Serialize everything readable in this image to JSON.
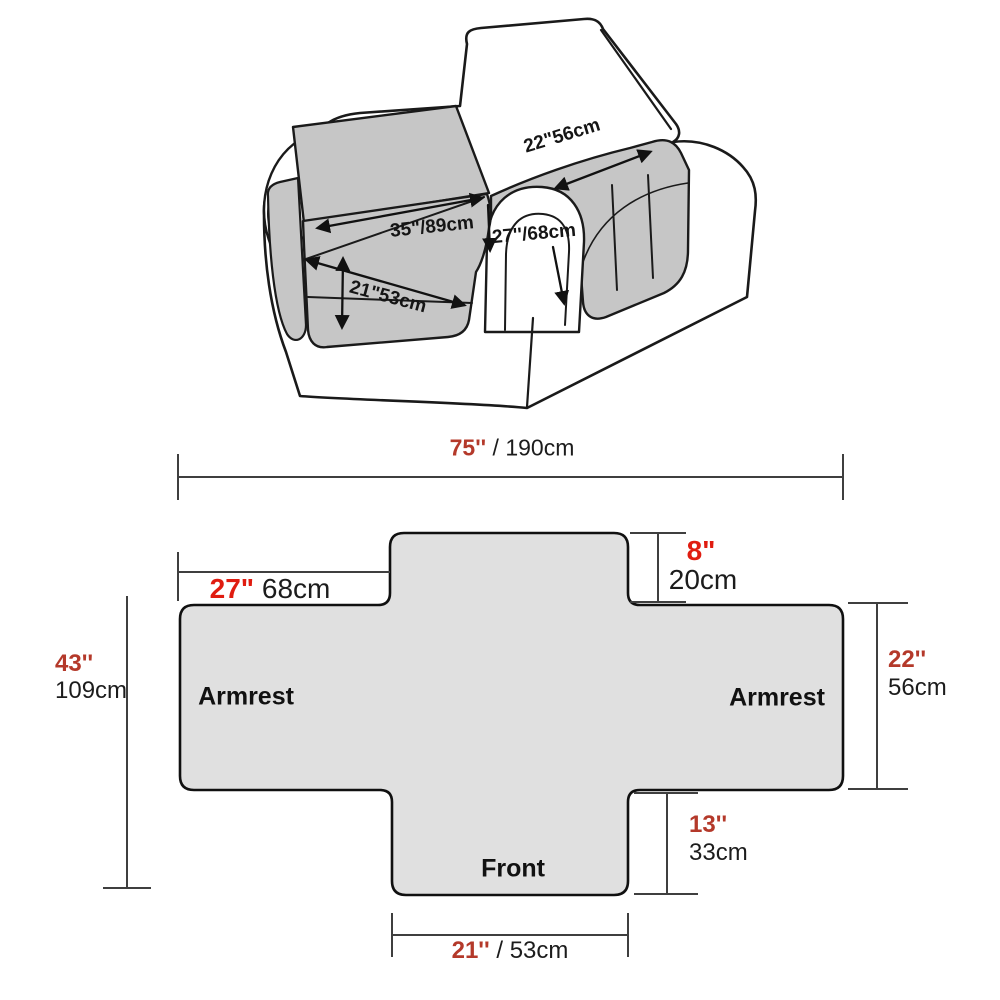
{
  "illustration_labels": {
    "armrest_length": "22\"56cm",
    "seat_depth": "35\"/89cm",
    "armrest_cover_width": "27''/68cm",
    "seat_width": "21\"53cm"
  },
  "flat_cover": {
    "total_width_in": "75''",
    "total_width_cm": " / 190cm",
    "armrest_section_width_in": "27\"",
    "armrest_section_width_cm": " 68cm",
    "back_flap_drop_in": "8\"",
    "back_flap_drop_cm": "20cm",
    "total_height_in": "43''",
    "total_height_cm": "109cm",
    "armrest_section_height_in": "22''",
    "armrest_section_height_cm": "56cm",
    "front_flap_drop_in": "13''",
    "front_flap_drop_cm": "33cm",
    "front_flap_width_in": "21''",
    "front_flap_width_cm": " / 53cm",
    "left_armrest_label": "Armrest",
    "right_armrest_label": "Armrest",
    "front_label": "Front"
  },
  "colors": {
    "accent_red_dark": "#b4392a",
    "accent_red_bright": "#e01c10",
    "chair_cover_gray": "#c6c6c6",
    "flat_cover_gray": "#e0e0e0",
    "outline": "#1a1a1a",
    "dimension_line": "#3f3f3f"
  }
}
